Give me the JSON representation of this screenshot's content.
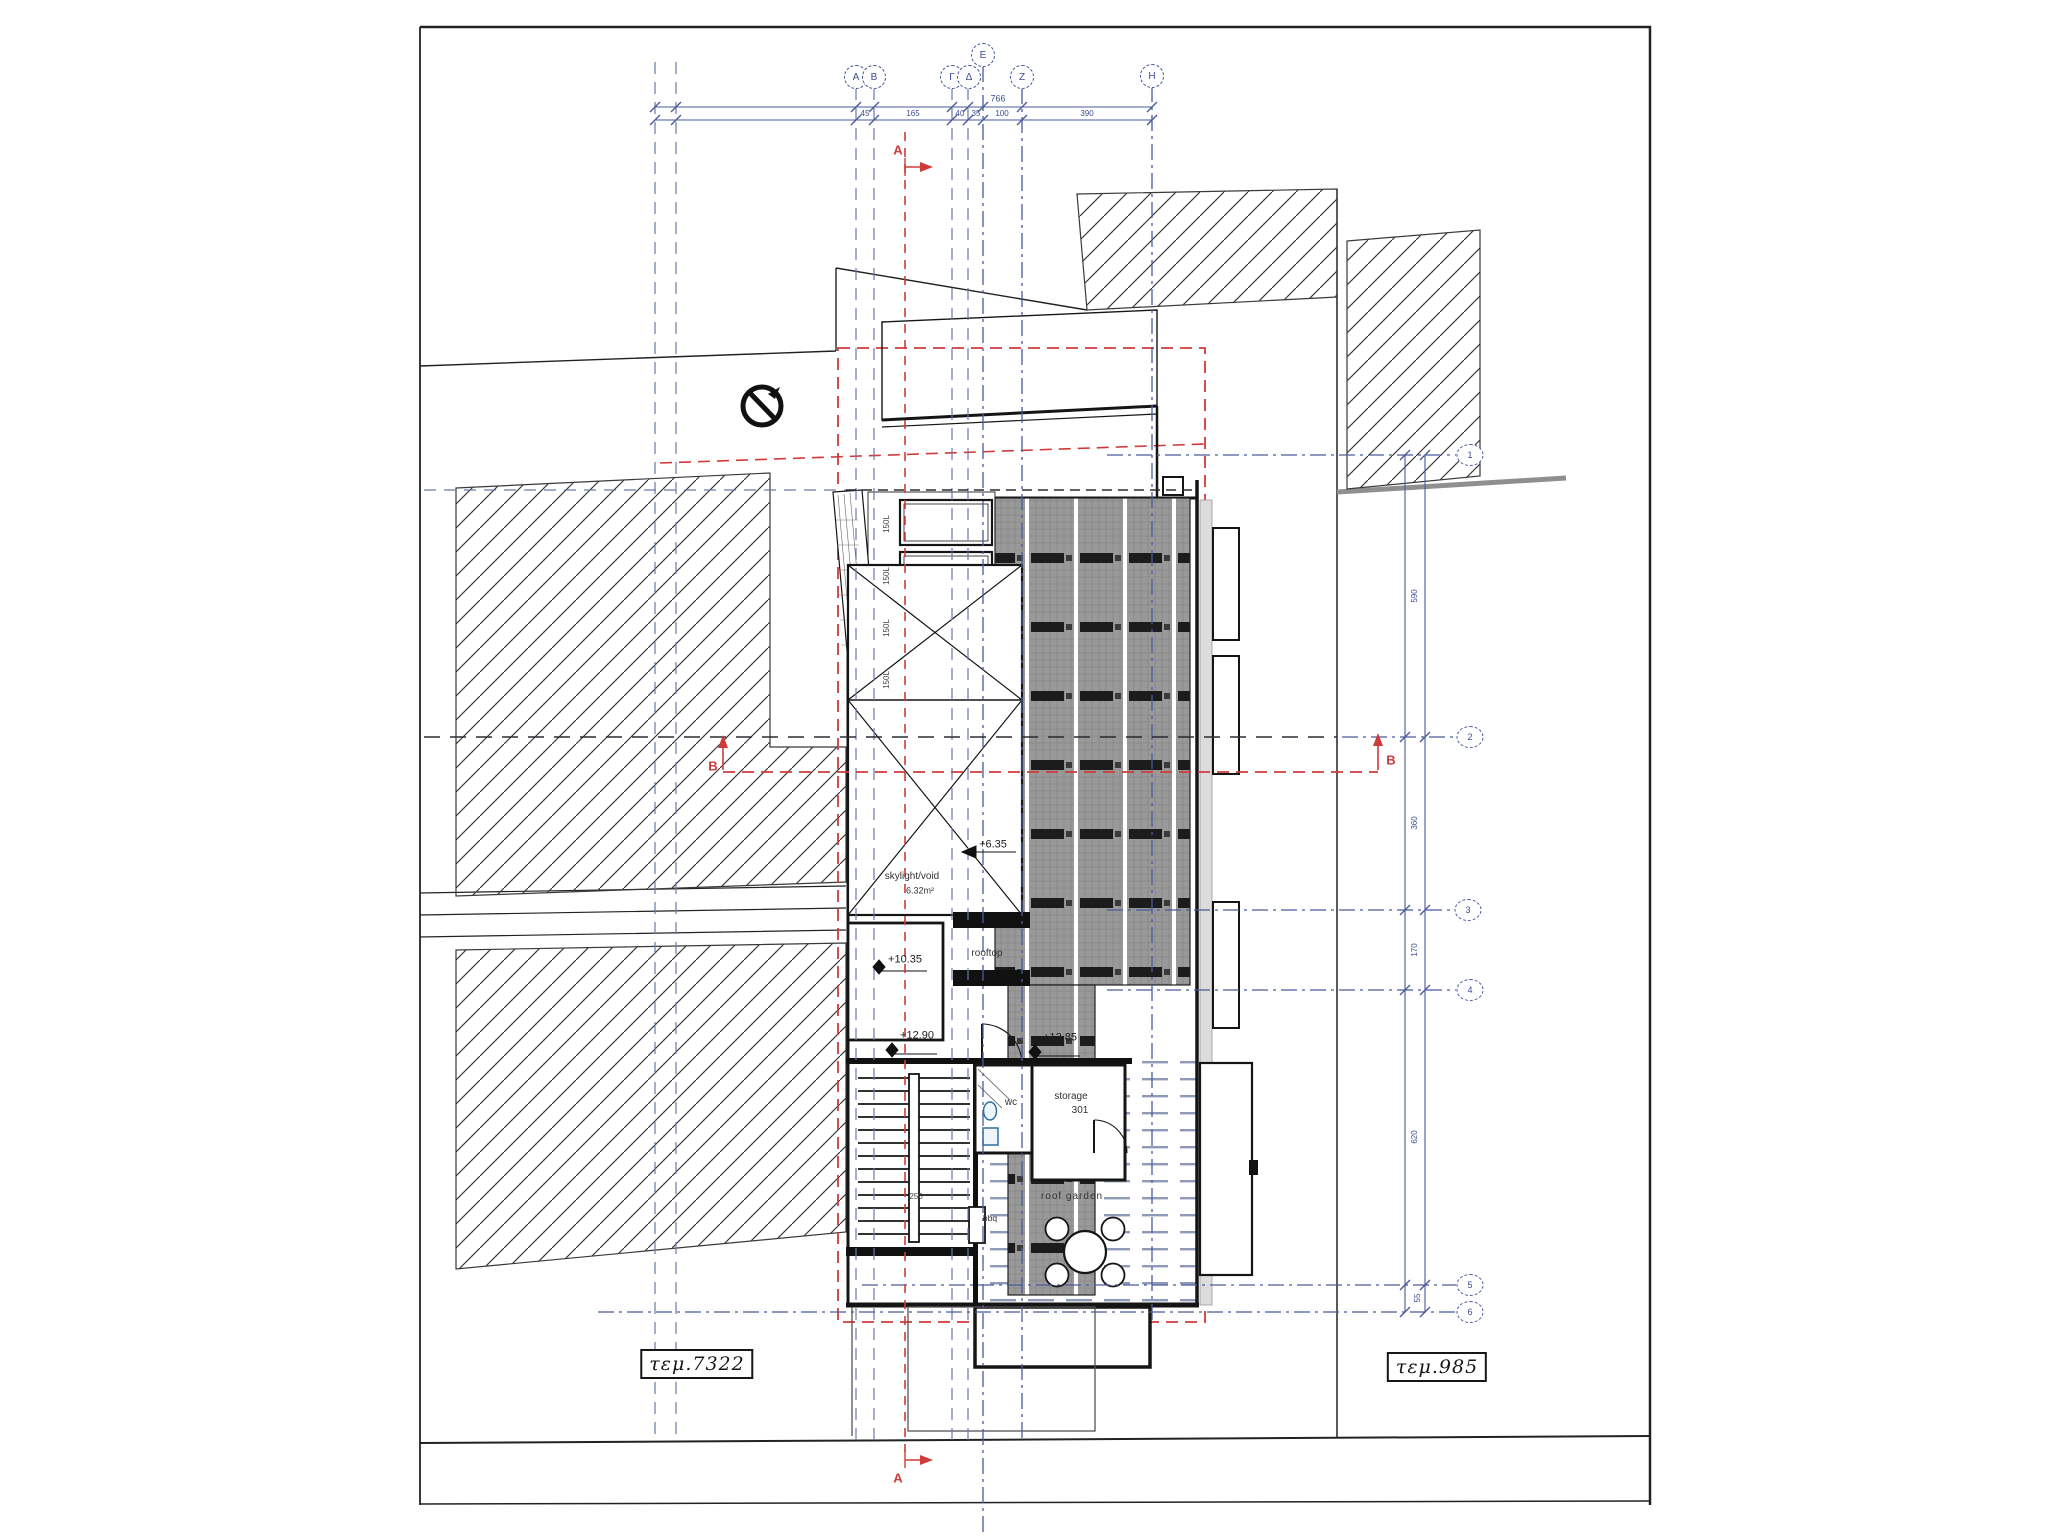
{
  "parcels": {
    "left": "τεμ.7322",
    "right": "τεμ.985"
  },
  "grid": {
    "top": [
      "Α",
      "Β",
      "Γ",
      "Δ",
      "Ε",
      "Ζ",
      "Η"
    ],
    "right": [
      "1",
      "2",
      "3",
      "4",
      "5",
      "6"
    ]
  },
  "sections": {
    "a": "A",
    "b": "B"
  },
  "levels": {
    "skylight": "+6.35",
    "terrace": "+10.35",
    "stair": "+12.90",
    "roof": "+12.85"
  },
  "labels": {
    "skylight": "skylight/void",
    "skylight_area": "6.32m²",
    "rooftop": "rooftop",
    "wc": "wc",
    "storage": "storage",
    "storage_number": "301",
    "roof_garden": "roof garden",
    "bbq": "bbq",
    "stair_dim": "250"
  },
  "tanks": [
    "150L",
    "150L",
    "150L",
    "150L"
  ],
  "dims": {
    "top_total": "766",
    "top_segments": [
      "45",
      "165",
      "40",
      "35",
      "100",
      "390"
    ],
    "right_segments": [
      "590",
      "360",
      "170",
      "620",
      "55"
    ]
  },
  "colors": {
    "grid_blue": "#4a5b9b",
    "section_red": "#cf3b3b",
    "line_black": "#1a1a1a",
    "panel_gray": "#999999"
  }
}
